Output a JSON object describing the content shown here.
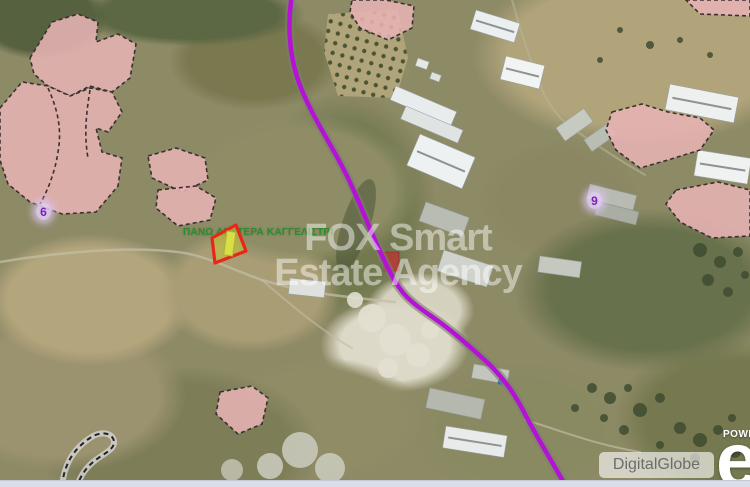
{
  "map": {
    "locality_label": "ΠΑΝΩ ΔΕΥΤΕΡΑ ΚΑΓΓΕΛΙΣΤΡΙ",
    "watermark": {
      "line1": "FOX Smart",
      "line2": "Estate Agency"
    },
    "zone_markers": [
      {
        "label": "6"
      },
      {
        "label": "9"
      }
    ],
    "attribution": "DigitalGlobe",
    "powered_by": "POWE",
    "provider_logo_letter": "e",
    "colors": {
      "route": "#b512d8",
      "parcel_outline": "#e8261c",
      "parcel_fill": "rgba(198,198,52,0.55)",
      "zone_fill": "rgba(231,179,180,0.88)",
      "locality_text": "#2e8c2e"
    }
  }
}
